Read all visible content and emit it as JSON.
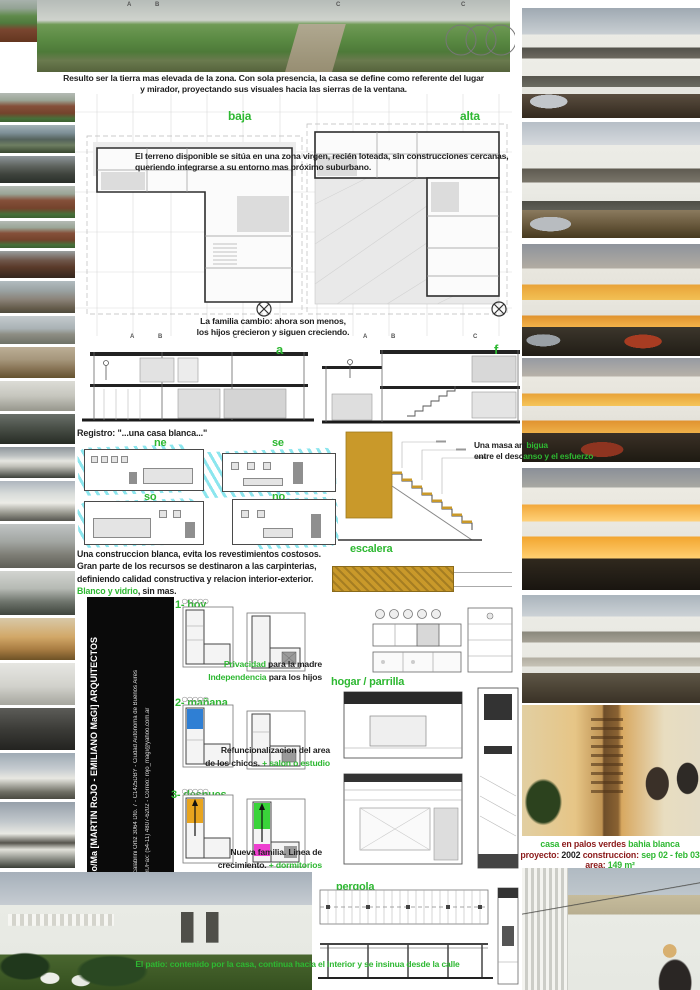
{
  "colors": {
    "accent_green": "#2eb832",
    "maroon": "#8b1a1a",
    "stair_yellow": "#c9992a",
    "scribble_cyan": "#7de1eb",
    "room_blue": "#2f7fd4",
    "room_orange": "#e8a41e",
    "room_green": "#3ad43a",
    "room_magenta": "#ee3fd0"
  },
  "top": {
    "grid_letters": [
      "A",
      "B",
      "C"
    ],
    "caption_line1": "Resulto ser la tierra mas elevada de la zona. Con sola presencia, la casa se define como referente del lugar",
    "caption_line2": "y mirador, proyectando sus visuales hacia las sierras de la ventana."
  },
  "plans": {
    "label_left": "baja",
    "label_right": "alta",
    "terrain_line1": "El terreno disponible se sitúa en una zona virgen, recién loteada, sin construcciones cercanas,",
    "terrain_line2": "queriendo integrarse a su entorno mas próximo suburbano.",
    "family_line1": "La familia cambio: ahora son menos,",
    "family_line2": "los hijos crecieron y siguen creciendo.",
    "section_label_a": "a",
    "section_label_f": "f",
    "grid_letters": [
      "A",
      "B",
      "C"
    ]
  },
  "registro": "Registro: \"...una casa blanca...\"",
  "elevations": {
    "ne": "ne",
    "se": "se",
    "so": "so",
    "no": "no"
  },
  "construction": {
    "line1": "Una construccion blanca, evita los revestimientos costosos.",
    "line2": "Gran parte de los recursos se destinaron a las carpinterias,",
    "line3": "definiendo calidad constructiva y relacion interior-exterior.",
    "final_green": "Blanco y vidrio",
    "final_dark": ", sin mas."
  },
  "firm": {
    "title": "Ro/Ma [MARTIN RoJO - EMILIANO MaGI] ARQUITECTOS",
    "address": "Scalabrini Ortiz 3064 Dto. 7 - C1425DBY - Ciudad Autonoma de Buenos Aires",
    "contact": "Tel./Fax:  (54-11) 4807-6202  -  Correo:  rojo_magi@yahoo.com.ar"
  },
  "tree_glyphs": "○○○○○",
  "phases": [
    {
      "label": "1- hoy",
      "line1_green": "Privacidad",
      "line1_dark": " para la madre",
      "line2_green": "Independencia",
      "line2_dark": " para los hijos"
    },
    {
      "label": "2- mañana",
      "line1_dark": "Refuncionalizacion del area",
      "line2_dark": "de los chicos. ",
      "line2_green": "+ salon o estudio"
    },
    {
      "label": "3- despues",
      "line1_dark": "Nueva familia. Linea de",
      "line2_dark": "crecimiento. ",
      "line2_green": "+ dormitorios"
    }
  ],
  "details": {
    "escalera": "escalera",
    "hogar": "hogar / parrilla",
    "pergola": "pergola"
  },
  "masa": {
    "l1_dark": "Una masa am",
    "l1_green": "bigua",
    "l2_dark": "entre el desc",
    "l2_green": "anso y el esfuerzo"
  },
  "project": {
    "t1_green": "casa",
    "t1_maroon": " en palos verdes ",
    "t1_green2": "bahia blanca",
    "l2_label1": "proyecto:",
    "l2_value1": " 2002 ",
    "l2_label2": "construccion:",
    "l2_value2": " sep 02 - feb 03",
    "l3_label": "area:",
    "l3_value": " 149 m²"
  },
  "patio_caption": "El patio: contenido por la casa, continua hacia el interior y se insinua desde la calle",
  "left_strip": {
    "photos": [
      {
        "type": "brickfield",
        "y": 0,
        "h": 42
      },
      {
        "type": "brick",
        "y": 93,
        "h": 29
      },
      {
        "type": "water",
        "y": 125,
        "h": 28
      },
      {
        "type": "concretedark",
        "y": 156,
        "h": 27
      },
      {
        "type": "brick",
        "y": 186,
        "h": 32
      },
      {
        "type": "brick",
        "y": 221,
        "h": 27
      },
      {
        "type": "brickdark",
        "y": 251,
        "h": 27
      },
      {
        "type": "concrete",
        "y": 281,
        "h": 32
      },
      {
        "type": "slabsky",
        "y": 316,
        "h": 28
      },
      {
        "type": "intladder",
        "y": 347,
        "h": 31
      },
      {
        "type": "intwhite",
        "y": 381,
        "h": 30
      },
      {
        "type": "intplant",
        "y": 414,
        "h": 30
      },
      {
        "type": "housedark",
        "y": 447,
        "h": 31
      },
      {
        "type": "housewhite",
        "y": 481,
        "h": 40
      },
      {
        "type": "concretegray",
        "y": 524,
        "h": 44
      },
      {
        "type": "intterrace",
        "y": 571,
        "h": 44
      },
      {
        "type": "intwarm",
        "y": 618,
        "h": 42
      },
      {
        "type": "whiteabs",
        "y": 663,
        "h": 42
      },
      {
        "type": "intdark",
        "y": 708,
        "h": 42
      },
      {
        "type": "housesky",
        "y": 753,
        "h": 46
      },
      {
        "type": "housetwo",
        "y": 802,
        "h": 66
      }
    ]
  },
  "right_column": {
    "photos": [
      {
        "type": "house-side",
        "y": 8,
        "h": 110
      },
      {
        "type": "house-front",
        "y": 122,
        "h": 116
      },
      {
        "type": "house-dusk",
        "y": 244,
        "h": 112
      },
      {
        "type": "house-dusk-angle",
        "y": 358,
        "h": 104
      },
      {
        "type": "house-night",
        "y": 468,
        "h": 122
      },
      {
        "type": "house-day",
        "y": 595,
        "h": 108
      },
      {
        "type": "interior-stair",
        "y": 705,
        "h": 131
      },
      {
        "type": "terrace-view",
        "y": 868,
        "h": 122
      }
    ]
  }
}
